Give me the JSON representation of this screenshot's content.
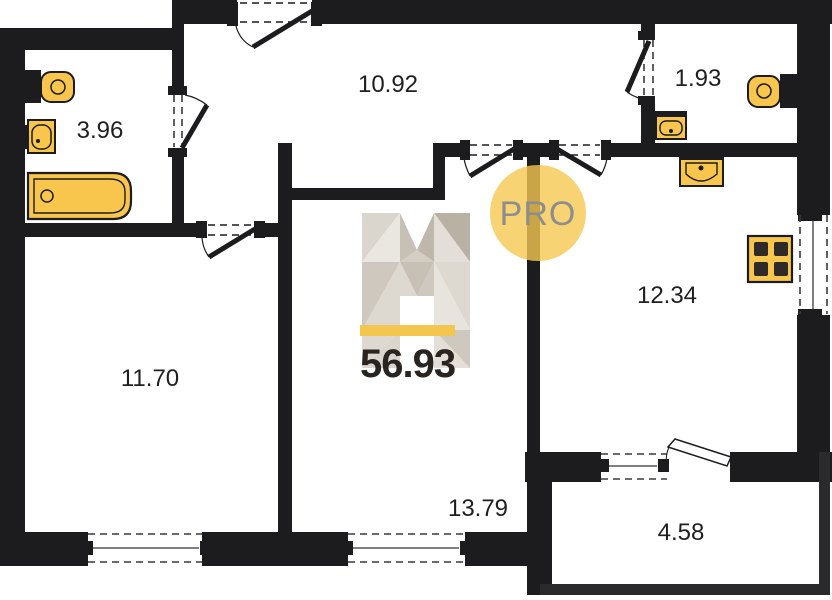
{
  "badge": {
    "label": "PRO"
  },
  "total": {
    "area": "56.93"
  },
  "rooms": {
    "bathroom": {
      "area": "3.96"
    },
    "hallway": {
      "area": "10.92"
    },
    "wc": {
      "area": "1.93"
    },
    "bedroom": {
      "area": "11.70"
    },
    "kitchen_living": {
      "area": "12.34"
    },
    "living_room": {
      "area": "13.79"
    },
    "balcony": {
      "area": "4.58"
    }
  },
  "icons": [
    "bathtub-icon",
    "toilet-icon",
    "sink-icon",
    "stove-icon",
    "logo-h-icon"
  ],
  "colors": {
    "wall": "#1c1c1e",
    "fixture_fill": "#F8C64D",
    "logo_bar": "#F2C64F",
    "badge_bg": "#F6C851",
    "badge_text": "#8D8D8D"
  }
}
